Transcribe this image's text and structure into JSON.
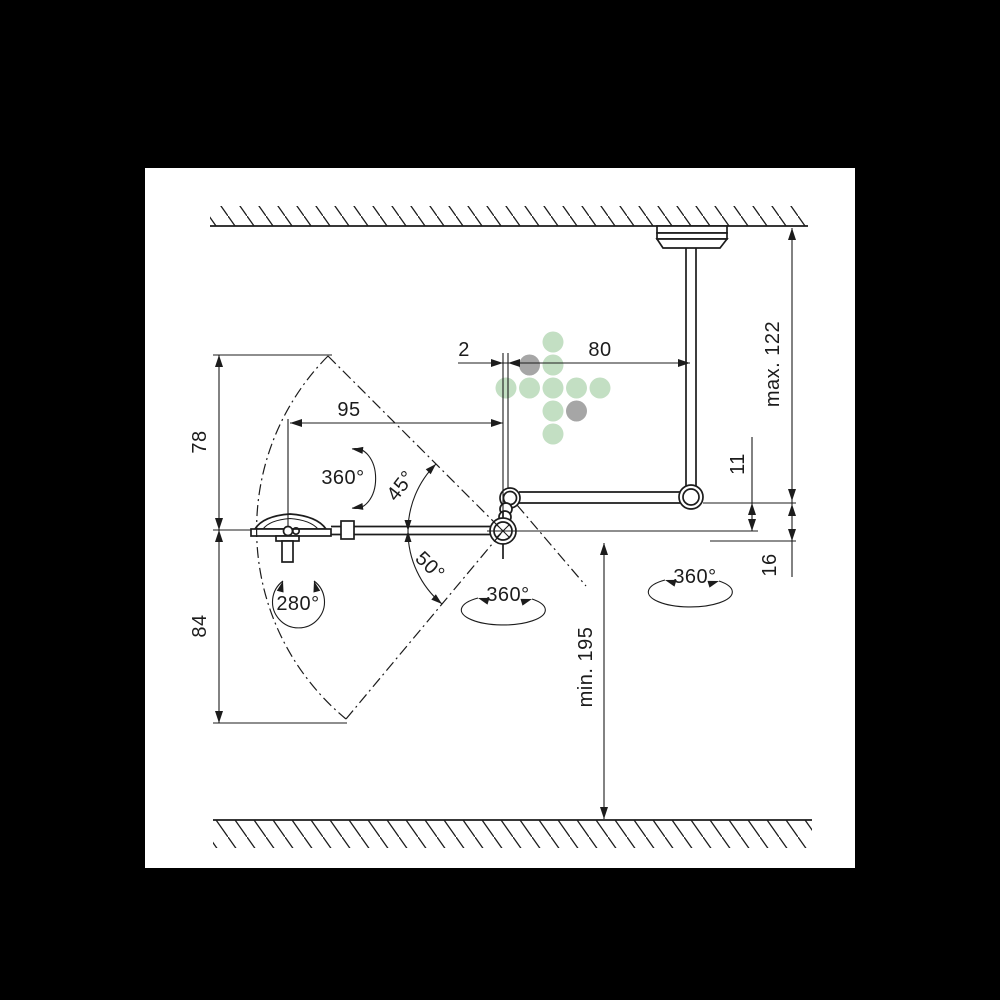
{
  "diagram": {
    "type": "technical-dimension-drawing",
    "subject": "ceiling-mounted articulated swivel arm with flat head, shown between hatched ceiling and floor",
    "colors": {
      "background": "#000000",
      "paper": "#ffffff",
      "line": "#1c1c1c",
      "logo_green": "#c3dfc3",
      "logo_gray": "#a6a6a6"
    },
    "dimensions": {
      "offset_top": "2",
      "arm_span_top": "80",
      "reach_mid": "95",
      "upper_height": "78",
      "lower_height": "84",
      "ceiling_to_arm": "max. 122",
      "floor_clearance": "min. 195",
      "arm_to_axis": "11",
      "arm_to_hub_bottom": "16"
    },
    "angles": {
      "head_spin": "360°",
      "head_swivel": "280°",
      "tilt_up": "45°",
      "tilt_down": "50°",
      "hub_rotation": "360°",
      "pole_rotation": "360°"
    }
  }
}
